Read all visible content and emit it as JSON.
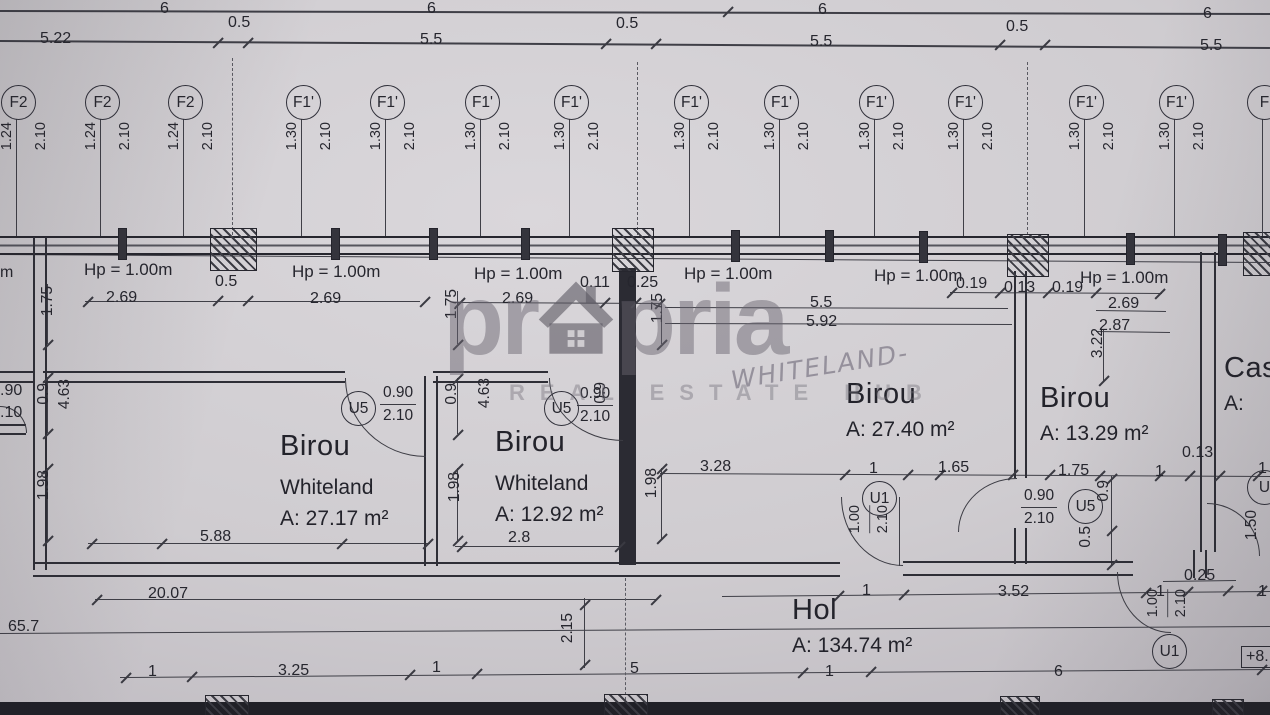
{
  "background": {
    "paper": "#cdcace",
    "ink": "#2b2b33",
    "line": "#3f3f47"
  },
  "watermark": {
    "brand_left": "pr",
    "brand_right": "pria",
    "tagline": "REAL ESTATE HUB"
  },
  "handwritten_note": {
    "text": "WHITELAND-"
  },
  "level_badge": {
    "t": "+8."
  },
  "hp_labels": [
    {
      "t": "Hp = 1.00m",
      "x": 84,
      "y": 260
    },
    {
      "t": "Hp = 1.00m",
      "x": 292,
      "y": 262
    },
    {
      "t": "Hp = 1.00m",
      "x": 474,
      "y": 264
    },
    {
      "t": "Hp = 1.00m",
      "x": 684,
      "y": 264
    },
    {
      "t": "Hp = 1.00m",
      "x": 874,
      "y": 266
    },
    {
      "t": "Hp = 1.00m",
      "x": 1080,
      "y": 268
    }
  ],
  "window_tags": [
    {
      "label": "F2",
      "w": "1.24",
      "h": "2.10",
      "cx": 17
    },
    {
      "label": "F2",
      "w": "1.24",
      "h": "2.10",
      "cx": 101
    },
    {
      "label": "F2",
      "w": "1.24",
      "h": "2.10",
      "cx": 184
    },
    {
      "label": "F1'",
      "w": "1.30",
      "h": "2.10",
      "cx": 302
    },
    {
      "label": "F1'",
      "w": "1.30",
      "h": "2.10",
      "cx": 386
    },
    {
      "label": "F1'",
      "w": "1.30",
      "h": "2.10",
      "cx": 481
    },
    {
      "label": "F1'",
      "w": "1.30",
      "h": "2.10",
      "cx": 570
    },
    {
      "label": "F1'",
      "w": "1.30",
      "h": "2.10",
      "cx": 690
    },
    {
      "label": "F1'",
      "w": "1.30",
      "h": "2.10",
      "cx": 780
    },
    {
      "label": "F1'",
      "w": "1.30",
      "h": "2.10",
      "cx": 875
    },
    {
      "label": "F1'",
      "w": "1.30",
      "h": "2.10",
      "cx": 964
    },
    {
      "label": "F1'",
      "w": "1.30",
      "h": "2.10",
      "cx": 1085
    },
    {
      "label": "F1'",
      "w": "1.30",
      "h": "2.10",
      "cx": 1175
    },
    {
      "label": "F",
      "w": "",
      "h": "",
      "cx": 1263
    }
  ],
  "door_tags": [
    {
      "label": "U5",
      "cx": 357,
      "cy": 407
    },
    {
      "label": "U5",
      "cx": 560,
      "cy": 407
    },
    {
      "label": "U1",
      "cx": 878,
      "cy": 497
    },
    {
      "label": "U5",
      "cx": 1084,
      "cy": 505
    },
    {
      "label": "U1",
      "cx": 1168,
      "cy": 650
    },
    {
      "label": "U",
      "cx": 1263,
      "cy": 486
    }
  ],
  "door_fracs": [
    {
      "w": "0.90",
      "h": "2.10",
      "x": 380,
      "y": 383,
      "o": "h"
    },
    {
      "w": "0.90",
      "h": "2.10",
      "x": 577,
      "y": 384,
      "o": "h"
    },
    {
      "w": "0.90",
      "h": "2.10",
      "x": 1021,
      "y": 486,
      "o": "h"
    },
    {
      "w": "1.00",
      "h": "2.10",
      "x": 848,
      "y": 505,
      "o": "v"
    },
    {
      "w": "1.00",
      "h": "2.10",
      "x": 1146,
      "y": 589,
      "o": "v"
    }
  ],
  "rooms": [
    {
      "name": "Birou",
      "tenant": "Whiteland",
      "area": "A: 27.17 m²",
      "x": 280,
      "y": 430
    },
    {
      "name": "Birou",
      "tenant": "Whiteland",
      "area": "A: 12.92 m²",
      "x": 495,
      "y": 426
    },
    {
      "name": "Birou",
      "tenant": "",
      "area": "A: 27.40 m²",
      "x": 846,
      "y": 378
    },
    {
      "name": "Birou",
      "tenant": "",
      "area": "A: 13.29 m²",
      "x": 1040,
      "y": 382
    },
    {
      "name": "Hol",
      "tenant": "",
      "area": "A: 134.74 m²",
      "x": 792,
      "y": 594
    },
    {
      "name": "Cas",
      "tenant": "",
      "area": "A:",
      "x": 1224,
      "y": 352
    }
  ],
  "dims": [
    {
      "t": "6",
      "x": 160,
      "y": 0
    },
    {
      "t": "6",
      "x": 427,
      "y": 0
    },
    {
      "t": "6",
      "x": 818,
      "y": 1
    },
    {
      "t": "6",
      "x": 1203,
      "y": 5
    },
    {
      "t": "5.22",
      "x": 40,
      "y": 30
    },
    {
      "t": "0.5",
      "x": 228,
      "y": 14
    },
    {
      "t": "5.5",
      "x": 420,
      "y": 31
    },
    {
      "t": "0.5",
      "x": 616,
      "y": 15
    },
    {
      "t": "5.5",
      "x": 810,
      "y": 33
    },
    {
      "t": "0.5",
      "x": 1006,
      "y": 18
    },
    {
      "t": "5.5",
      "x": 1200,
      "y": 37
    },
    {
      "t": "2.69",
      "x": 106,
      "y": 289
    },
    {
      "t": "0.5",
      "x": 215,
      "y": 273
    },
    {
      "t": "2.69",
      "x": 310,
      "y": 290
    },
    {
      "t": "2.69",
      "x": 502,
      "y": 290
    },
    {
      "t": "0.11",
      "x": 580,
      "y": 274
    },
    {
      "t": "0.25",
      "x": 627,
      "y": 274
    },
    {
      "t": "5.5",
      "x": 810,
      "y": 294
    },
    {
      "t": "5.92",
      "x": 806,
      "y": 313
    },
    {
      "t": "0.19",
      "x": 956,
      "y": 275
    },
    {
      "t": "0.13",
      "x": 1004,
      "y": 279
    },
    {
      "t": "0.19",
      "x": 1052,
      "y": 279
    },
    {
      "t": "2.69",
      "x": 1108,
      "y": 295
    },
    {
      "t": "2.87",
      "x": 1099,
      "y": 317
    },
    {
      "t": "3.28",
      "x": 700,
      "y": 458
    },
    {
      "t": "1",
      "x": 869,
      "y": 460
    },
    {
      "t": "1.65",
      "x": 938,
      "y": 459
    },
    {
      "t": "1.75",
      "x": 1058,
      "y": 462
    },
    {
      "t": "1",
      "x": 1155,
      "y": 463
    },
    {
      "t": "0.13",
      "x": 1182,
      "y": 444
    },
    {
      "t": "1",
      "x": 1258,
      "y": 460
    },
    {
      "t": "5.88",
      "x": 200,
      "y": 528
    },
    {
      "t": "2.8",
      "x": 508,
      "y": 529
    },
    {
      "t": "20.07",
      "x": 148,
      "y": 585
    },
    {
      "t": "1",
      "x": 862,
      "y": 582
    },
    {
      "t": "3.52",
      "x": 998,
      "y": 583
    },
    {
      "t": "1",
      "x": 1156,
      "y": 583
    },
    {
      "t": "0.25",
      "x": 1184,
      "y": 567
    },
    {
      "t": "1",
      "x": 1258,
      "y": 583
    },
    {
      "t": "65.7",
      "x": 8,
      "y": 618
    },
    {
      "t": "1",
      "x": 148,
      "y": 663
    },
    {
      "t": "3.25",
      "x": 278,
      "y": 662
    },
    {
      "t": "1",
      "x": 432,
      "y": 659
    },
    {
      "t": "5",
      "x": 630,
      "y": 660
    },
    {
      "t": "1",
      "x": 825,
      "y": 663
    },
    {
      "t": "6",
      "x": 1054,
      "y": 663
    },
    {
      "t": ".90",
      "x": 0,
      "y": 382
    },
    {
      "t": ".10",
      "x": 0,
      "y": 404
    },
    {
      "t": "m",
      "x": 0,
      "y": 264
    },
    {
      "t": "1.75",
      "x": 40,
      "y": 286,
      "v": 1
    },
    {
      "t": "0.9",
      "x": 36,
      "y": 383,
      "v": 1
    },
    {
      "t": "4.63",
      "x": 57,
      "y": 379,
      "v": 1
    },
    {
      "t": "1.98",
      "x": 36,
      "y": 470,
      "v": 1
    },
    {
      "t": "1.75",
      "x": 444,
      "y": 289,
      "v": 1
    },
    {
      "t": "0.9",
      "x": 444,
      "y": 383,
      "v": 1
    },
    {
      "t": "4.63",
      "x": 477,
      "y": 378,
      "v": 1
    },
    {
      "t": "1.98",
      "x": 447,
      "y": 472,
      "v": 1
    },
    {
      "t": "1.75",
      "x": 650,
      "y": 293,
      "v": 1
    },
    {
      "t": "1.98",
      "x": 644,
      "y": 468,
      "v": 1
    },
    {
      "t": "0.9",
      "x": 593,
      "y": 382,
      "v": 1
    },
    {
      "t": "3.22",
      "x": 1090,
      "y": 328,
      "v": 1
    },
    {
      "t": "0.9",
      "x": 1096,
      "y": 480,
      "v": 1
    },
    {
      "t": "0.5",
      "x": 1078,
      "y": 526,
      "v": 1
    },
    {
      "t": "2.15",
      "x": 560,
      "y": 613,
      "v": 1
    },
    {
      "t": "1.50",
      "x": 1244,
      "y": 510,
      "v": 1
    }
  ]
}
